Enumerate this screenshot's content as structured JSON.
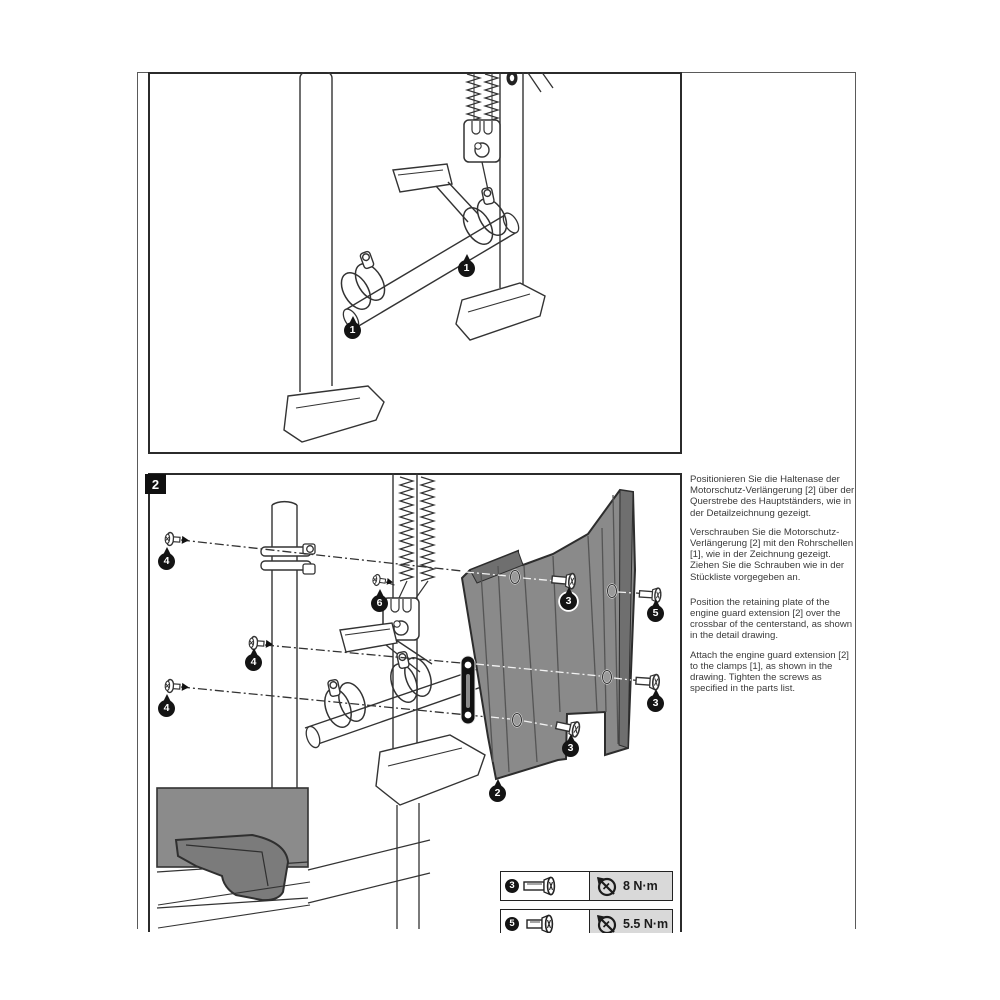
{
  "page": {
    "step": "2"
  },
  "callouts": {
    "c1": "1",
    "c2": "2",
    "c3": "3",
    "c4": "4",
    "c5": "5",
    "c6": "6"
  },
  "instructions": {
    "de": [
      "Positionieren Sie die Haltenase der Motorschutz-Verlängerung [2] über der Querstrebe des Hauptständers, wie in der Detailzeichnung gezeigt.",
      "Verschrauben Sie die Motorschutz-Verlängerung [2] mit den Rohrschellen [1], wie in der Zeichnung gezeigt.\nZiehen Sie die Schrauben wie in der Stückliste vorgegeben an."
    ],
    "en": [
      "Position the retaining plate of the engine guard extension [2] over the crossbar of the centerstand, as shown in the detail drawing.",
      "Attach the engine guard extension [2] to the clamps [1], as shown in the drawing. Tighten the screws as specified in the parts list."
    ]
  },
  "torque_table": {
    "rows": [
      {
        "callout": "3",
        "value": "8 N·m"
      },
      {
        "callout": "5",
        "value": "5.5 N·m"
      }
    ]
  },
  "colors": {
    "plate_gray": "#8a8a8a",
    "table_cell_gray": "#d9d9d9",
    "line_art": "#333333"
  }
}
